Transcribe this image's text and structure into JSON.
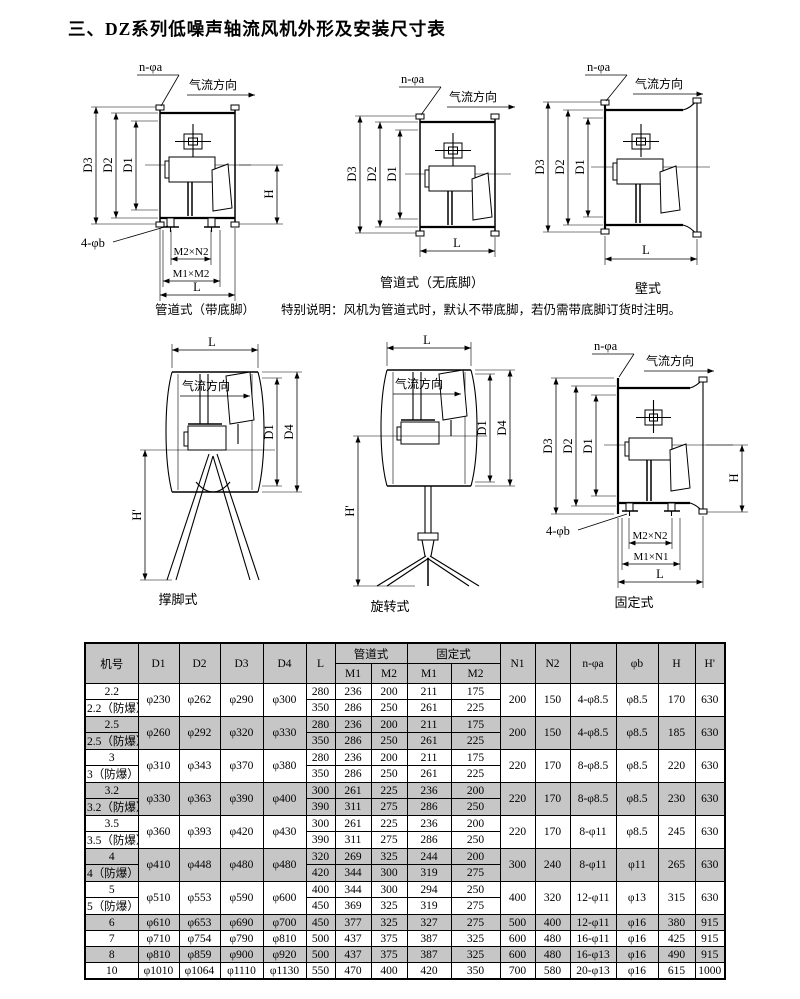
{
  "page": {
    "title": "三、DZ系列低噪声轴流风机外形及安装尺寸表"
  },
  "colors": {
    "table_shade": "#c6c6c6",
    "line": "#000000",
    "background": "#ffffff"
  },
  "diagrams": {
    "flow": "气流方向",
    "labels": {
      "d1": "D1",
      "d2": "D2",
      "d3": "D3",
      "d4": "D4",
      "h": "H",
      "hprime": "H'",
      "l": "L",
      "n_phi_a": "n-φa",
      "four_phi_b": "4-φb",
      "m2n2": "M2×N2",
      "m1m2": "M1×M2",
      "m1n1": "M1×N1"
    },
    "captions": {
      "duct_feet": "管道式（带底脚）",
      "duct_nofeet": "管道式（无底脚）",
      "wall": "壁式",
      "tripod": "撑脚式",
      "rotary": "旋转式",
      "fixed": "固定式"
    },
    "note": "特别说明：风机为管道式时，默认不带底脚，若仍需带底脚订货时注明。"
  },
  "table": {
    "header": {
      "jihao": "机号",
      "d1": "D1",
      "d2": "D2",
      "d3": "D3",
      "d4": "D4",
      "l": "L",
      "guandao": "管道式",
      "guding": "固定式",
      "m1": "M1",
      "m2": "M2",
      "n1": "N1",
      "n2": "N2",
      "nfa": "n-φa",
      "fb": "φb",
      "h": "H",
      "hp": "H'"
    },
    "groups": [
      {
        "shaded": false,
        "names": [
          "2.2",
          "2.2（防爆）"
        ],
        "d": [
          "φ230",
          "φ262",
          "φ290",
          "φ300"
        ],
        "subs": [
          [
            "280",
            "236",
            "200",
            "211",
            "175"
          ],
          [
            "350",
            "286",
            "250",
            "261",
            "225"
          ]
        ],
        "tail": [
          "200",
          "150",
          "4-φ8.5",
          "φ8.5",
          "170",
          "630"
        ]
      },
      {
        "shaded": true,
        "names": [
          "2.5",
          "2.5（防爆）"
        ],
        "d": [
          "φ260",
          "φ292",
          "φ320",
          "φ330"
        ],
        "subs": [
          [
            "280",
            "236",
            "200",
            "211",
            "175"
          ],
          [
            "350",
            "286",
            "250",
            "261",
            "225"
          ]
        ],
        "tail": [
          "200",
          "150",
          "4-φ8.5",
          "φ8.5",
          "185",
          "630"
        ]
      },
      {
        "shaded": false,
        "names": [
          "3",
          "3（防爆）"
        ],
        "d": [
          "φ310",
          "φ343",
          "φ370",
          "φ380"
        ],
        "subs": [
          [
            "280",
            "236",
            "200",
            "211",
            "175"
          ],
          [
            "350",
            "286",
            "250",
            "261",
            "225"
          ]
        ],
        "tail": [
          "220",
          "170",
          "8-φ8.5",
          "φ8.5",
          "220",
          "630"
        ]
      },
      {
        "shaded": true,
        "names": [
          "3.2",
          "3.2（防爆）"
        ],
        "d": [
          "φ330",
          "φ363",
          "φ390",
          "φ400"
        ],
        "subs": [
          [
            "300",
            "261",
            "225",
            "236",
            "200"
          ],
          [
            "390",
            "311",
            "275",
            "286",
            "250"
          ]
        ],
        "tail": [
          "220",
          "170",
          "8-φ8.5",
          "φ8.5",
          "230",
          "630"
        ]
      },
      {
        "shaded": false,
        "names": [
          "3.5",
          "3.5（防爆）"
        ],
        "d": [
          "φ360",
          "φ393",
          "φ420",
          "φ430"
        ],
        "subs": [
          [
            "300",
            "261",
            "225",
            "236",
            "200"
          ],
          [
            "390",
            "311",
            "275",
            "286",
            "250"
          ]
        ],
        "tail": [
          "220",
          "170",
          "8-φ11",
          "φ8.5",
          "245",
          "630"
        ]
      },
      {
        "shaded": true,
        "names": [
          "4",
          "4（防爆）"
        ],
        "d": [
          "φ410",
          "φ448",
          "φ480",
          "φ480"
        ],
        "subs": [
          [
            "320",
            "269",
            "325",
            "244",
            "200"
          ],
          [
            "420",
            "344",
            "300",
            "319",
            "275"
          ]
        ],
        "tail": [
          "300",
          "240",
          "8-φ11",
          "φ11",
          "265",
          "630"
        ]
      },
      {
        "shaded": false,
        "names": [
          "5",
          "5（防爆）"
        ],
        "d": [
          "φ510",
          "φ553",
          "φ590",
          "φ600"
        ],
        "subs": [
          [
            "400",
            "344",
            "300",
            "294",
            "250"
          ],
          [
            "450",
            "369",
            "325",
            "319",
            "275"
          ]
        ],
        "tail": [
          "400",
          "320",
          "12-φ11",
          "φ13",
          "315",
          "630"
        ]
      },
      {
        "shaded": true,
        "names": [
          "6"
        ],
        "d": [
          "φ610",
          "φ653",
          "φ690",
          "φ700"
        ],
        "subs": [
          [
            "450",
            "377",
            "325",
            "327",
            "275"
          ]
        ],
        "tail": [
          "500",
          "400",
          "12-φ11",
          "φ16",
          "380",
          "915"
        ]
      },
      {
        "shaded": false,
        "names": [
          "7"
        ],
        "d": [
          "φ710",
          "φ754",
          "φ790",
          "φ810"
        ],
        "subs": [
          [
            "500",
            "437",
            "375",
            "387",
            "325"
          ]
        ],
        "tail": [
          "600",
          "480",
          "16-φ11",
          "φ16",
          "425",
          "915"
        ]
      },
      {
        "shaded": true,
        "names": [
          "8"
        ],
        "d": [
          "φ810",
          "φ859",
          "φ900",
          "φ920"
        ],
        "subs": [
          [
            "500",
            "437",
            "375",
            "387",
            "325"
          ]
        ],
        "tail": [
          "600",
          "480",
          "16-φ13",
          "φ16",
          "490",
          "915"
        ]
      },
      {
        "shaded": false,
        "names": [
          "10"
        ],
        "d": [
          "φ1010",
          "φ1064",
          "φ1110",
          "φ1130"
        ],
        "subs": [
          [
            "550",
            "470",
            "400",
            "420",
            "350"
          ]
        ],
        "tail": [
          "700",
          "580",
          "20-φ13",
          "φ16",
          "615",
          "1000"
        ]
      }
    ]
  }
}
